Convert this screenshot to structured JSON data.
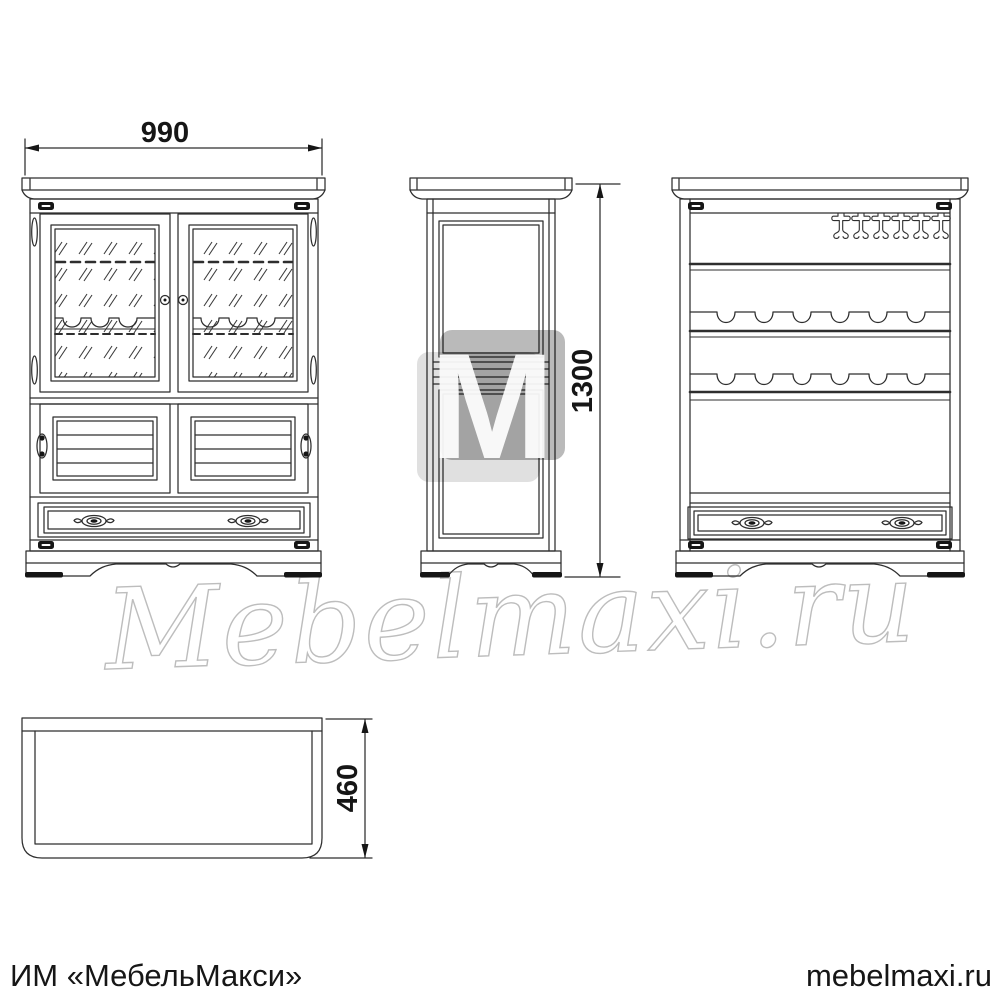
{
  "drawing": {
    "dimensions": {
      "width_mm": "990",
      "height_mm": "1300",
      "depth_mm": "460"
    },
    "watermark": {
      "script_text": "Mebelmaxi.ru",
      "logo_letter": "M"
    },
    "footer": {
      "left_text": "ИМ «МебельМакси»",
      "right_text": "mebelmaxi.ru"
    },
    "colors": {
      "background": "#ffffff",
      "line": "#2e2e2e",
      "watermark_gray": "#bdbdbd",
      "footer_text": "#161616"
    }
  }
}
